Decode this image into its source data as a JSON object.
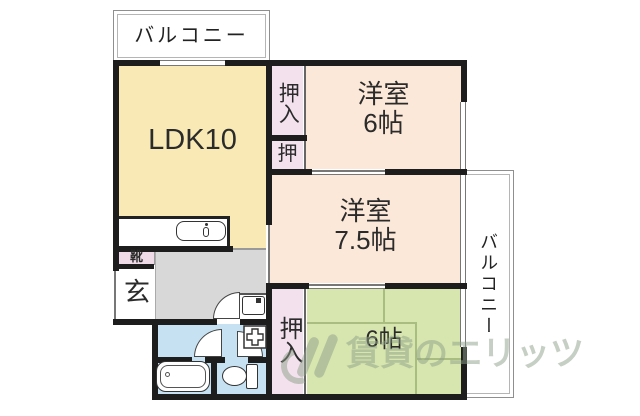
{
  "plan": {
    "balcony_top": {
      "label": "バルコニー"
    },
    "balcony_right": {
      "label": "バルコニー"
    },
    "rooms": {
      "ldk": {
        "label": "LDK10"
      },
      "west_room_6": {
        "name": "洋室",
        "size": "6帖"
      },
      "west_room_75": {
        "name": "洋室",
        "size": "7.5帖"
      },
      "tatami_6": {
        "label": "6帖"
      },
      "closet_top": {
        "label": "押入"
      },
      "closet_mid": {
        "label": "押"
      },
      "closet_bottom": {
        "label": "押入"
      },
      "entrance": {
        "label": "玄"
      },
      "shoe_box": {
        "label": "靴"
      }
    },
    "watermark": {
      "text": "賃貸のエリッツ"
    },
    "colors": {
      "wall": "#1d1d1d",
      "ldk_fill": "#f9e9b4",
      "western_fill": "#fce8d8",
      "tatami_fill": "#d7e5ae",
      "closet_fill": "#f3e2ee",
      "shoe_fill": "#eedbe7",
      "hall_fill": "#d8d8d8",
      "wet_fill": "#c6e2f2",
      "tatami_line": "#a9bd80",
      "watermark": "#8fa08a"
    }
  }
}
